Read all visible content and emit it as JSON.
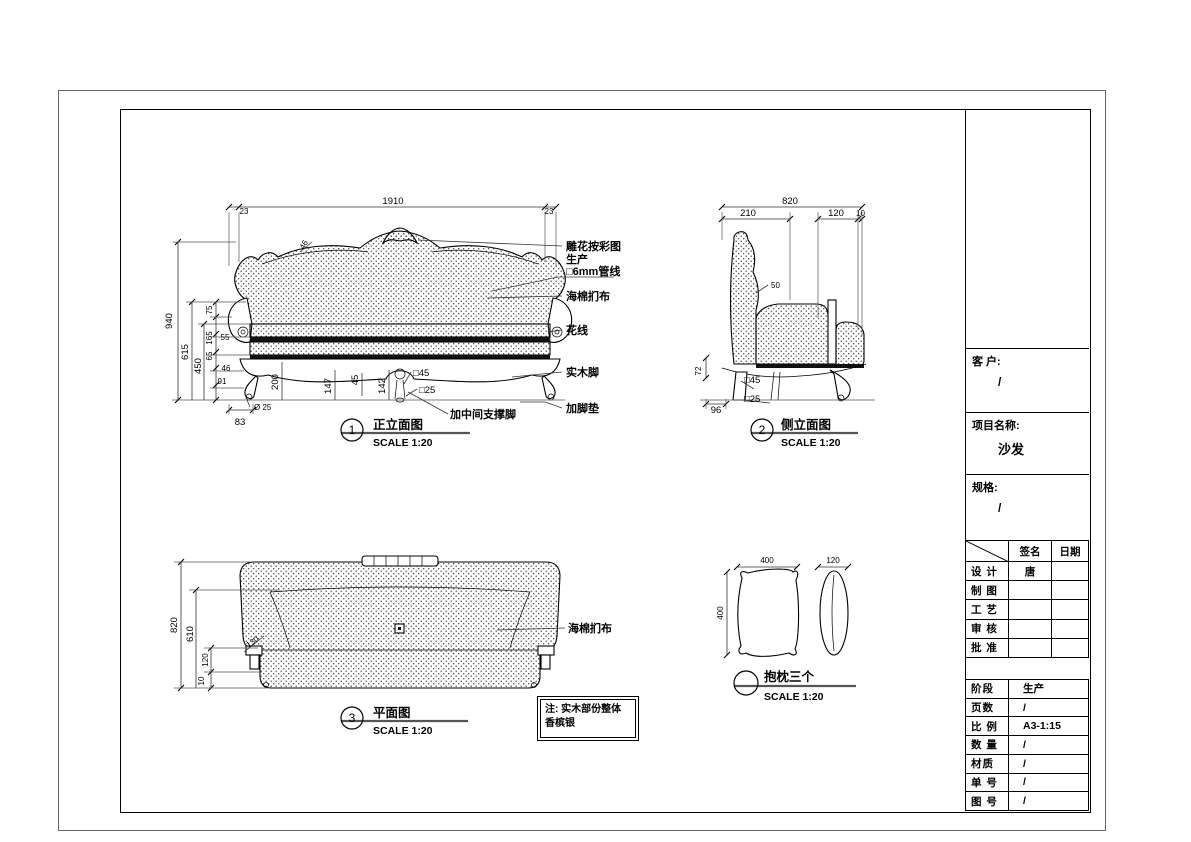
{
  "front_view": {
    "caption_no": "1",
    "caption_title": "正立面图",
    "caption_scale": "SCALE 1:20",
    "dims": {
      "total_width": "1910",
      "overhang_left": "23",
      "overhang_right": "23",
      "crest": "46",
      "total_height": "940",
      "back_height": "615",
      "seat_height": "450",
      "d75": "75",
      "d165": "165",
      "d65": "65",
      "d55": "55",
      "d46": "46",
      "d91": "91",
      "d200": "200",
      "d147": "147",
      "d45": "45",
      "d142": "142",
      "sq45": "□45",
      "sq25": "□25",
      "d83": "83",
      "dia25": "Ø 25"
    },
    "callouts": {
      "carving": "雕花按彩图",
      "production": "生产",
      "pipe": "□6mm管线",
      "sponge": "海棉扪布",
      "trim": "花线",
      "wood_leg": "实木脚",
      "foot_pad": "加脚垫",
      "center_leg": "加中间支撑脚"
    }
  },
  "side_view": {
    "caption_no": "2",
    "caption_title": "侧立面图",
    "caption_scale": "SCALE 1:20",
    "dims": {
      "total_depth": "820",
      "d210": "210",
      "d120": "120",
      "d10": "10",
      "d50": "50",
      "d72": "72",
      "d96": "96",
      "sq45": "□45",
      "sq25": "□25"
    }
  },
  "plan_view": {
    "caption_no": "3",
    "caption_title": "平面图",
    "caption_scale": "SCALE 1:20",
    "dims": {
      "d820": "820",
      "d610": "610",
      "d130": "130",
      "d120": "120",
      "d10": "10"
    },
    "callout_sponge": "海棉扪布"
  },
  "pillow_view": {
    "caption_title": "抱枕三个",
    "caption_scale": "SCALE 1:20",
    "dims": {
      "width": "400",
      "height": "400",
      "thickness": "120"
    }
  },
  "note": {
    "line1": "注: 实木部份整体",
    "line2": "香槟银"
  },
  "title_block": {
    "customer_label": "客 户:",
    "customer_value": "/",
    "project_label": "项目名称:",
    "project_value": "沙发",
    "spec_label": "规格:",
    "spec_value": "/",
    "sign_col": "签名",
    "date_col": "日期",
    "sign_rows": [
      {
        "label": "设 计",
        "signature": "唐",
        "date": ""
      },
      {
        "label": "制 图",
        "signature": "",
        "date": ""
      },
      {
        "label": "工 艺",
        "signature": "",
        "date": ""
      },
      {
        "label": "审 核",
        "signature": "",
        "date": ""
      },
      {
        "label": "批 准",
        "signature": "",
        "date": ""
      }
    ],
    "info_rows": [
      {
        "label": "阶段",
        "value": "生产"
      },
      {
        "label": "页数",
        "value": "/"
      },
      {
        "label": "比 例",
        "value": "A3-1:15"
      },
      {
        "label": "数 量",
        "value": "/"
      },
      {
        "label": "材质",
        "value": "/"
      },
      {
        "label": "单 号",
        "value": "/"
      },
      {
        "label": "图 号",
        "value": "/"
      }
    ]
  }
}
